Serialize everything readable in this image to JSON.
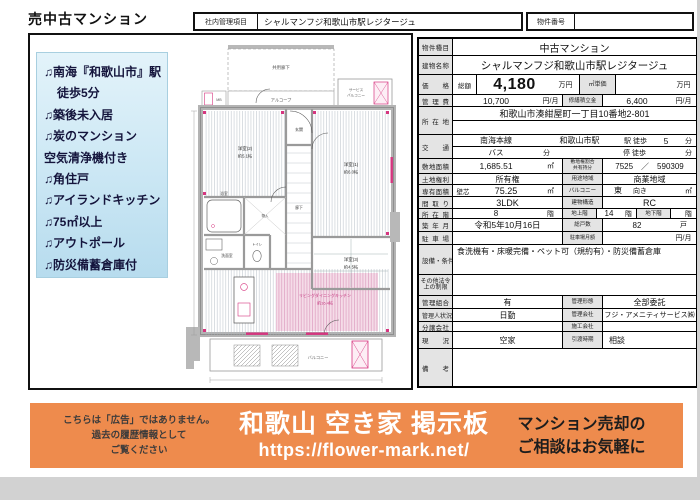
{
  "page": {
    "title": "売中古マンション",
    "header": {
      "internal_label": "社内管理項目",
      "internal_value": "シャルマンフジ和歌山市駅レジタージュ",
      "property_no_label": "物件番号",
      "property_no_value": ""
    }
  },
  "colors": {
    "banner_orange": "#ee8b4d",
    "feature_box_blue": "#cfe9f5",
    "plan_pink": "#d6357f",
    "table_label_gray": "#e4e4e4"
  },
  "features": {
    "items": [
      {
        "note": "♫",
        "text": "南海『和歌山市』駅"
      },
      {
        "note": "",
        "text": "徒歩5分"
      },
      {
        "note": "♫",
        "text": "築後未入居"
      },
      {
        "note": "♫",
        "text": "炭のマンション"
      },
      {
        "note": "",
        "text": "空気清浄機付き"
      },
      {
        "note": "♫",
        "text": "角住戸"
      },
      {
        "note": "♫",
        "text": "アイランドキッチン"
      },
      {
        "note": "♫",
        "text": "75㎡以上"
      },
      {
        "note": "♫",
        "text": "アウトポール"
      },
      {
        "note": "♫",
        "text": "防災備蓄倉庫付"
      }
    ]
  },
  "floor_plan": {
    "labels": {
      "common_corridor": "共用廊下",
      "alcove": "アルコーブ",
      "service_balcony_1": "サービス",
      "service_balcony_2": "バルコニー",
      "meter_box": "MB",
      "entrance": "玄関",
      "hallway": "廊下",
      "bedroom2": "洋室(2)",
      "bedroom2_size": "約5.1帖",
      "bedroom1": "洋室(1)",
      "bedroom1_size": "約6.0帖",
      "bedroom3": "洋室(3)",
      "bedroom3_size": "約4.5帖",
      "bath": "浴室",
      "washroom": "洗面室",
      "toilet": "トイレ",
      "closet": "物入",
      "ldk": "リビングダイニングキッチン",
      "ldk_size": "約16.4帖",
      "balcony": "バルコニー"
    }
  },
  "table": {
    "property_type": {
      "label": "物件種目",
      "value": "中古マンション"
    },
    "building_name": {
      "label": "建物名称",
      "value": "シャルマンフジ和歌山市駅レジタージュ"
    },
    "price": {
      "label": "価格",
      "total_label": "総額",
      "total_value": "4,180",
      "total_unit": "万円",
      "sqm_label": "㎡単価",
      "sqm_value": "",
      "sqm_unit": "万円"
    },
    "admin_fee": {
      "label": "管理費",
      "value": "10,700",
      "unit": "円/月",
      "repair_label": "修繕積立金",
      "repair_value": "6,400",
      "repair_unit": "円/月"
    },
    "location": {
      "label": "所在地",
      "value": "和歌山市湊紺屋町一丁目10番地2-801",
      "value2": ""
    },
    "transport": {
      "label": "交通",
      "line": "南海本線",
      "station": "和歌山市駅",
      "walk_label": "駅 徒歩",
      "walk_value": "5",
      "walk_unit": "分",
      "bus_label": "バス",
      "bus_unit": "分",
      "stop_label": "停 徒歩",
      "stop_unit": "分"
    },
    "land_area": {
      "label": "敷地面積",
      "value": "1,685.51",
      "unit": "㎡",
      "ratio_label1": "敷地権割合",
      "ratio_label2": "共有持分",
      "ratio_value": "7525　／　590309"
    },
    "land_rights": {
      "label": "土地権利",
      "value": "所有権",
      "zone_label": "用途地域",
      "zone_value": "商業地域"
    },
    "exclusive_area": {
      "label": "専有面積",
      "sub": "壁芯",
      "value": "75.25",
      "unit": "㎡",
      "balcony_label": "バルコニー",
      "dir": "東",
      "facing": "向き",
      "balcony_unit": "㎡"
    },
    "layout": {
      "label": "間取り",
      "value": "3LDK",
      "structure_label": "建物構造",
      "structure_value": "RC"
    },
    "floor": {
      "label": "所在階",
      "value": "8",
      "unit": "階",
      "above_label": "地上階",
      "above_value": "14",
      "above_unit": "階",
      "below_label": "地下階",
      "below_value": "",
      "below_unit": "階"
    },
    "built": {
      "label": "築年月",
      "value": "令和5年10月16日",
      "units_label": "総戸数",
      "units_value": "82",
      "units_unit": "戸"
    },
    "parking": {
      "label": "駐車場",
      "value": "",
      "fee_label": "駐車場月額",
      "fee_value": "",
      "fee_unit": "円/月"
    },
    "equipment": {
      "label": "設備・条件",
      "value": "食洗機有・床暖完備・ペット可（規約有）・防災備蓄倉庫"
    },
    "other_restrictions": {
      "label1": "その他法令",
      "label2": "上の制限",
      "value": ""
    },
    "mgmt_assoc": {
      "label": "管理組合",
      "value": "有",
      "form_label": "管理形態",
      "form_value": "全部委託"
    },
    "manager": {
      "label": "管理人状況",
      "value": "日勤",
      "company_label": "管理会社",
      "company_value": "フジ・アメニティサービス㈱"
    },
    "seller": {
      "label": "分譲会社",
      "value": "",
      "builder_label": "施工会社",
      "builder_value": ""
    },
    "status": {
      "label": "現況",
      "value": "空家",
      "handover_label": "引渡時期",
      "handover_value": "相談"
    },
    "remarks": {
      "label": "備考",
      "value": ""
    }
  },
  "banner": {
    "disclaimer_line1": "こちらは「広告」ではありません。",
    "disclaimer_line2": "過去の履歴情報として",
    "disclaimer_line3": "ご覧ください",
    "site_title": "和歌山 空き家 掲示板",
    "site_url": "https://flower-mark.net/",
    "cta_line1": "マンション売却の",
    "cta_line2": "ご相談はお気軽に"
  }
}
